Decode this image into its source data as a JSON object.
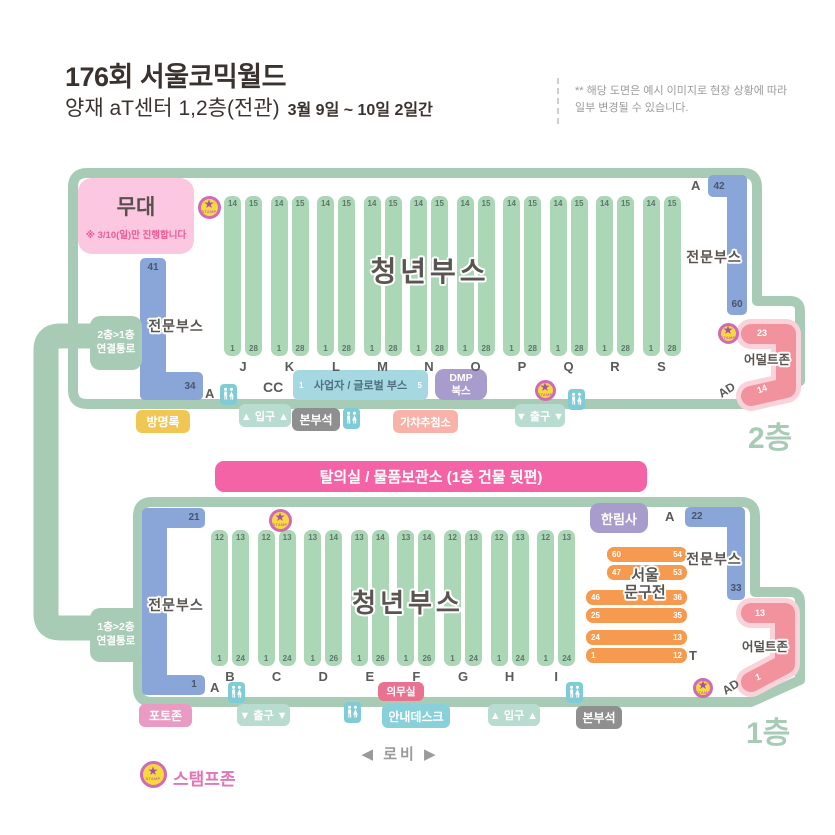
{
  "header": {
    "title": "176회 서울코믹월드",
    "subtitle": "양재 aT센터 1,2층(전관)",
    "date_range": "3월 9일 ~ 10일 2일간",
    "notice_line1": "** 해당 도면은 예시 이미지로 현장 상황에 따라",
    "notice_line2": "일부 변경될 수 있습니다."
  },
  "connector": {
    "top_label_line1": "2층>1층",
    "top_label_line2": "연결통로",
    "bottom_label_line1": "1층>2층",
    "bottom_label_line2": "연결통로"
  },
  "floor2": {
    "floor_label": "2층",
    "stage_label": "무대",
    "stage_note": "※ 3/10(일)만 진행합니다",
    "youth_booth_label": "청년부스",
    "pro_left": {
      "label": "전문부스",
      "top_num": "41",
      "bottom_num": "34"
    },
    "pro_right": {
      "label": "전문부스",
      "top_num": "42",
      "bottom_num": "60"
    },
    "a_left": "A",
    "a_right": "A",
    "cc_label": "CC",
    "business_booth": {
      "label": "사업자 / 글로벌 부스",
      "num_left": "1",
      "num_right": "5"
    },
    "dmp_line1": "DMP",
    "dmp_line2": "북스",
    "adult_zone": {
      "label": "어덜트존",
      "top_num": "23",
      "bottom_num": "14",
      "ad_label": "AD"
    },
    "guestbook": "방명록",
    "entrance": "▲ 입구 ▲",
    "hq": "본부석",
    "gacha": "가챠추첨소",
    "exit": "▼ 출구 ▼",
    "columns": [
      {
        "letter": "J",
        "top_left": "14",
        "top_right": "15",
        "bottom_left": "1",
        "bottom_right": "28"
      },
      {
        "letter": "K",
        "top_left": "14",
        "top_right": "15",
        "bottom_left": "1",
        "bottom_right": "28"
      },
      {
        "letter": "L",
        "top_left": "14",
        "top_right": "15",
        "bottom_left": "1",
        "bottom_right": "28"
      },
      {
        "letter": "M",
        "top_left": "14",
        "top_right": "15",
        "bottom_left": "1",
        "bottom_right": "28"
      },
      {
        "letter": "N",
        "top_left": "14",
        "top_right": "15",
        "bottom_left": "1",
        "bottom_right": "28"
      },
      {
        "letter": "O",
        "top_left": "14",
        "top_right": "15",
        "bottom_left": "1",
        "bottom_right": "28"
      },
      {
        "letter": "P",
        "top_left": "14",
        "top_right": "15",
        "bottom_left": "1",
        "bottom_right": "28"
      },
      {
        "letter": "Q",
        "top_left": "14",
        "top_right": "15",
        "bottom_left": "1",
        "bottom_right": "28"
      },
      {
        "letter": "R",
        "top_left": "14",
        "top_right": "15",
        "bottom_left": "1",
        "bottom_right": "28"
      },
      {
        "letter": "S",
        "top_left": "14",
        "top_right": "15",
        "bottom_left": "1",
        "bottom_right": "28"
      }
    ]
  },
  "floor1": {
    "floor_label": "1층",
    "banner": "탈의실 / 물품보관소 (1층 건물 뒷편)",
    "youth_booth_label": "청년부스",
    "pro_left": {
      "label": "전문부스",
      "top_num": "21",
      "bottom_num": "1"
    },
    "pro_right": {
      "label": "전문부스",
      "top_num": "22",
      "bottom_num": "33"
    },
    "a_left": "A",
    "a_right": "A",
    "hallimsa": "한림사",
    "stationery": {
      "line1": "서울",
      "line2": "문구전",
      "t_label": "T",
      "bars": [
        {
          "left": "60",
          "right": "54"
        },
        {
          "left": "47",
          "right": "53"
        },
        {
          "left": "46",
          "right": "36"
        },
        {
          "left": "25",
          "right": "35"
        },
        {
          "left": "24",
          "right": "13"
        },
        {
          "left": "1",
          "right": "12"
        }
      ]
    },
    "adult_zone": {
      "label": "어덜트존",
      "top_num": "13",
      "bottom_num": "1",
      "ad_label": "AD"
    },
    "medical": "의무실",
    "photo_zone": "포토존",
    "exit": "▼ 출구 ▼",
    "info_desk": "안내데스크",
    "entrance": "▲ 입구 ▲",
    "hq": "본부석",
    "columns": [
      {
        "letter": "B",
        "top_left": "12",
        "top_right": "13",
        "bottom_left": "1",
        "bottom_right": "24"
      },
      {
        "letter": "C",
        "top_left": "12",
        "top_right": "13",
        "bottom_left": "1",
        "bottom_right": "24"
      },
      {
        "letter": "D",
        "top_left": "13",
        "top_right": "14",
        "bottom_left": "1",
        "bottom_right": "26"
      },
      {
        "letter": "E",
        "top_left": "13",
        "top_right": "14",
        "bottom_left": "1",
        "bottom_right": "26"
      },
      {
        "letter": "F",
        "top_left": "13",
        "top_right": "14",
        "bottom_left": "1",
        "bottom_right": "26"
      },
      {
        "letter": "G",
        "top_left": "12",
        "top_right": "13",
        "bottom_left": "1",
        "bottom_right": "24"
      },
      {
        "letter": "H",
        "top_left": "12",
        "top_right": "13",
        "bottom_left": "1",
        "bottom_right": "24"
      },
      {
        "letter": "I",
        "top_left": "12",
        "top_right": "13",
        "bottom_left": "1",
        "bottom_right": "24"
      }
    ]
  },
  "footer": {
    "lobby": "◀  로비  ▶",
    "stamp_zone": "스탬프존",
    "stamp_text": "STAMP"
  },
  "colors": {
    "map_green": "#a8cbb6",
    "booth_green": "#abd7b7",
    "pro_blue": "#8aa5d7",
    "adult_pink": "#f2929d",
    "stationery_orange": "#f69a4f",
    "banner_pink": "#f463a5",
    "purple": "#a89ccd"
  }
}
